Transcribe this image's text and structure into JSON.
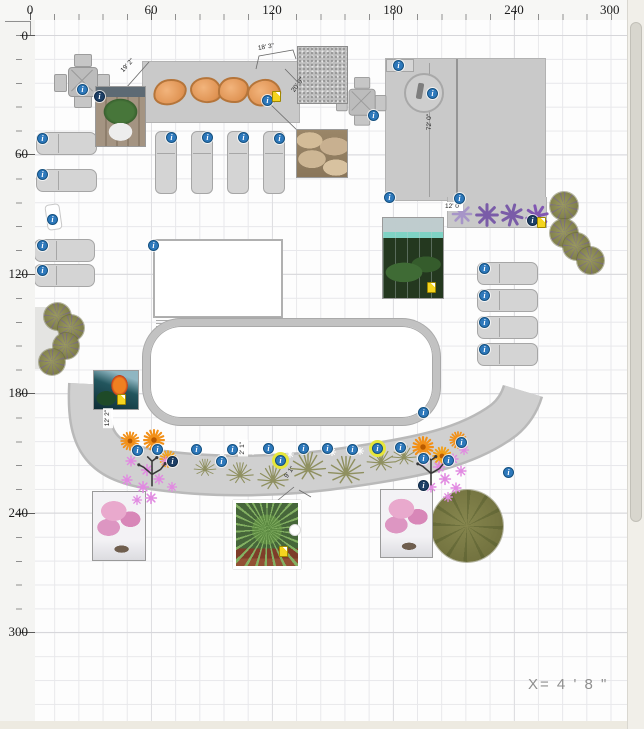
{
  "window": {
    "coordinate_readout": "X=  4 '  8 \""
  },
  "rulers": {
    "top": {
      "labels": [
        "0",
        "60",
        "120",
        "180",
        "240",
        "300"
      ]
    },
    "left": {
      "labels": [
        "0",
        "60",
        "120",
        "180",
        "240",
        "300"
      ]
    }
  },
  "dimensions": {
    "patio_width": "18' 3\"",
    "patio_diag": "19' 2\"",
    "walk_diag": "20' 0\"",
    "building_height": "72' 0\"",
    "band_width": "12' 0\"",
    "bed_height": "12' 2\"",
    "plant_spacing": "2' 1\"",
    "palm_offset": "9' 1\""
  },
  "icons": {
    "info": "i",
    "note": "attached-note",
    "purple_flower": "aster-symbol",
    "orange_flower": "burst-symbol",
    "pink_flower": "small-aster-symbol",
    "grass": "grass-clump-symbol",
    "branch": "branch-plant-symbol"
  }
}
